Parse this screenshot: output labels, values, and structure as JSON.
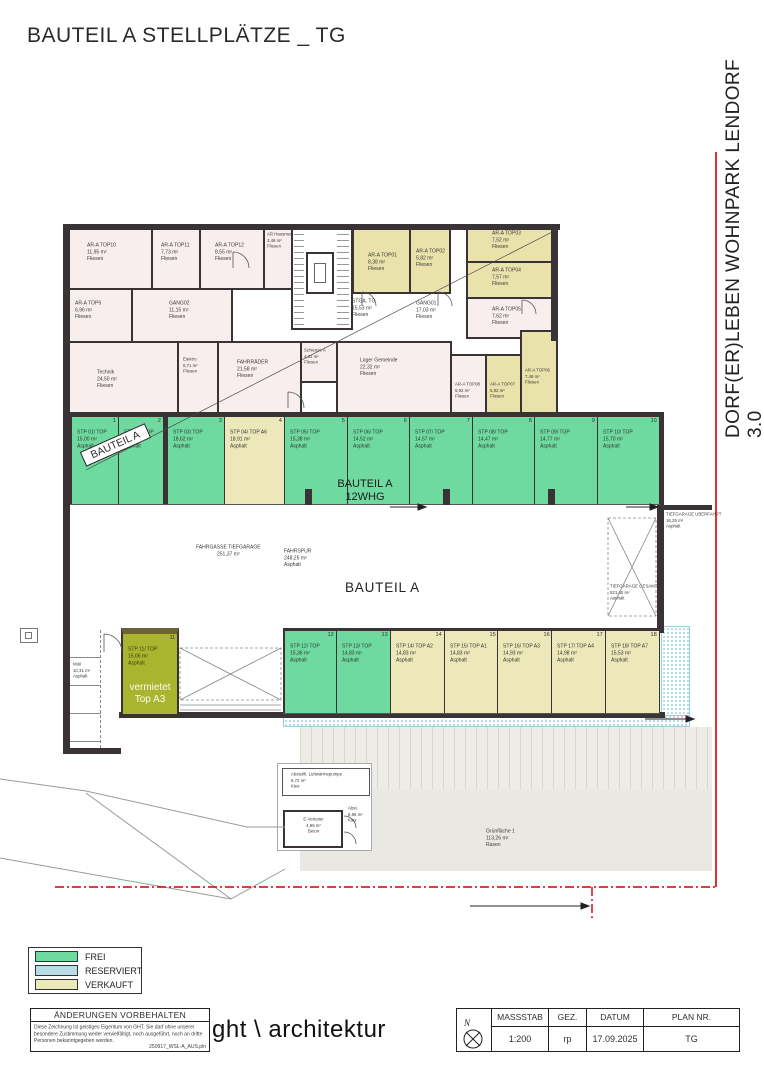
{
  "header": {
    "title": "BAUTEIL A STELLPLÄTZE _ TG"
  },
  "side": {
    "project_title": "DORF(ER)LEBEN WOHNPARK LENDORF 3.0"
  },
  "colors": {
    "frei": "#6fdaa0",
    "reserviert": "#b9dde8",
    "verkauft": "#ece8ba",
    "vermietet": "#a9b52f",
    "wall": "#3a3336",
    "boundary_red": "#cf0000",
    "room_pink": "#f9eeee",
    "room_yellow": "#eae2ab"
  },
  "rooms": [
    {
      "name": "AR-A TOP10",
      "area": "11,95 m²",
      "finish": "Fliesen"
    },
    {
      "name": "AR-A TOP11",
      "area": "7,73 m²",
      "finish": "Fliesen"
    },
    {
      "name": "AR-A TOP12",
      "area": "8,55 m²",
      "finish": "Fliesen"
    },
    {
      "name": "AR Hausmeister",
      "area": "3,46 m²",
      "finish": "Fliesen"
    },
    {
      "name": "AR-A TOP9",
      "area": "6,96 m²",
      "finish": "Fliesen"
    },
    {
      "name": "GANG02",
      "area": "11,15 m²",
      "finish": "Fliesen"
    },
    {
      "name": "AR-A TOP01",
      "area": "8,38 m²",
      "finish": "Fliesen"
    },
    {
      "name": "AR-A TOP02",
      "area": "5,82 m²",
      "finish": "Fliesen"
    },
    {
      "name": "AR-A TOP03",
      "area": "7,52 m²",
      "finish": "Fliesen"
    },
    {
      "name": "AR-A TOP04",
      "area": "7,57 m²",
      "finish": "Fliesen"
    },
    {
      "name": "AR-A TOP05",
      "area": "7,62 m²",
      "finish": "Fliesen"
    },
    {
      "name": "STGA. TG",
      "area": "15,53 m²",
      "finish": "Fliesen"
    },
    {
      "name": "GANG01",
      "area": "17,03 m²",
      "finish": "Fliesen"
    },
    {
      "name": "Technik",
      "area": "24,50 m²",
      "finish": "Fliesen"
    },
    {
      "name": "Elektro",
      "area": "6,71 m²",
      "finish": "Fliesen"
    },
    {
      "name": "FAHRRÄDER",
      "area": "21,58 m²",
      "finish": "Fliesen"
    },
    {
      "name": "Schleuse A",
      "area": "4,32 m²",
      "finish": "Fliesen"
    },
    {
      "name": "Lager Gemeinde",
      "area": "22,32 m²",
      "finish": "Fliesen"
    },
    {
      "name": "AR-A TOP08",
      "area": "5,92 m²",
      "finish": "Fliesen"
    },
    {
      "name": "AR-A TOP07",
      "area": "5,82 m²",
      "finish": "Fliesen"
    },
    {
      "name": "AR-A TOP06",
      "area": "7,48 m²",
      "finish": "Fliesen"
    }
  ],
  "parking": {
    "row1": [
      {
        "num": "1",
        "name": "STP 01/ TOP",
        "area": "15,00 m²",
        "finish": "Asphalt",
        "status": "frei"
      },
      {
        "num": "2",
        "name": "STP 02/ TOP",
        "area": "14,84 m²",
        "finish": "Asphalt",
        "status": "frei"
      },
      {
        "num": "3",
        "name": "STP 03/ TOP",
        "area": "18,62 m²",
        "finish": "Asphalt",
        "status": "frei"
      },
      {
        "num": "4",
        "name": "STP 04/ TOP A6",
        "area": "18,91 m²",
        "finish": "Asphalt",
        "status": "verkauft"
      },
      {
        "num": "5",
        "name": "STP 05/ TOP",
        "area": "15,38 m²",
        "finish": "Asphalt",
        "status": "frei"
      },
      {
        "num": "6",
        "name": "STP 06/ TOP",
        "area": "14,52 m²",
        "finish": "Asphalt",
        "status": "frei"
      },
      {
        "num": "7",
        "name": "STP 07/ TOP",
        "area": "14,57 m²",
        "finish": "Asphalt",
        "status": "frei"
      },
      {
        "num": "8",
        "name": "STP 08/ TOP",
        "area": "14,47 m²",
        "finish": "Asphalt",
        "status": "frei"
      },
      {
        "num": "9",
        "name": "STP 09/ TOP",
        "area": "14,77 m²",
        "finish": "Asphalt",
        "status": "frei"
      },
      {
        "num": "10",
        "name": "STP 10/ TOP",
        "area": "15,70 m²",
        "finish": "Asphalt",
        "status": "frei"
      }
    ],
    "row2": [
      {
        "num": "12",
        "name": "STP 12/ TOP",
        "area": "15,36 m²",
        "finish": "Asphalt",
        "status": "frei"
      },
      {
        "num": "13",
        "name": "STP 13/ TOP",
        "area": "14,83 m²",
        "finish": "Asphalt",
        "status": "frei"
      },
      {
        "num": "14",
        "name": "STP 14/ TOP A2",
        "area": "14,83 m²",
        "finish": "Asphalt",
        "status": "verkauft"
      },
      {
        "num": "15",
        "name": "STP 15/ TOP A1",
        "area": "14,83 m²",
        "finish": "Asphalt",
        "status": "verkauft"
      },
      {
        "num": "16",
        "name": "STP 16/ TOP A3",
        "area": "14,93 m²",
        "finish": "Asphalt",
        "status": "verkauft"
      },
      {
        "num": "17",
        "name": "STP 17/ TOP A4",
        "area": "14,98 m²",
        "finish": "Asphalt",
        "status": "verkauft"
      },
      {
        "num": "18",
        "name": "STP 18/ TOP A7",
        "area": "15,53 m²",
        "finish": "Asphalt",
        "status": "verkauft"
      }
    ],
    "spot11": {
      "num": "11",
      "name": "STP 11/ TOP",
      "area": "15,06 m²",
      "finish": "Asphalt",
      "note_line1": "vermietet",
      "note_line2": "Top A3"
    }
  },
  "areas": {
    "fahrgasse": {
      "name": "FAHRGASSE TIEFGARAGE",
      "area": "251,37 m²"
    },
    "fahrspur": {
      "name": "FAHRSPUR",
      "area": "248,25 m²",
      "finish": "Asphalt"
    },
    "bauteil_big": "BAUTEIL A",
    "bauteil_banner": "BAUTEIL A",
    "bauteil_whg1": "BAUTEIL A",
    "bauteil_whg2": "12WHG",
    "ueberfahrt": {
      "name": "TIEFGARAGE ÜBERFAHRT",
      "area": "16,25 m²",
      "finish": "Asphalt"
    },
    "gesamt": {
      "name": "TIEFGARAGE GESAMT",
      "area": "521,60 m²",
      "finish": "Asphalt"
    },
    "muell": {
      "name": "Müll",
      "area": "10,31 m²",
      "finish": "Asphalt"
    },
    "abstellflaeche": {
      "name": "Abstellfl. Luftwärmepumpe",
      "area": "6,72 m²",
      "finish": "Kies"
    },
    "e_verteiler": {
      "name": "E-Verteiler",
      "area": "4,96 m²",
      "finish": "Beton"
    },
    "abst": {
      "name": "Abst.",
      "area": "6,86 m²",
      "finish": "Kies"
    },
    "gruenflaeche": {
      "name": "Grünfläche 1",
      "area": "113,26 m²",
      "finish": "Rasen"
    }
  },
  "legend": {
    "items": [
      {
        "label": "FREI",
        "color": "#6fdaa0"
      },
      {
        "label": "RESERVIERT",
        "color": "#b9dde8"
      },
      {
        "label": "VERKAUFT",
        "color": "#ece8ba"
      }
    ]
  },
  "titleblock": {
    "changes_header": "ÄNDERUNGEN VORBEHALTEN",
    "disclaimer": "Diese Zeichnung ist geistiges Eigentum von GHT. Sie darf ohne unserer besondere Zustimmung weder vervielfältigt, noch ausgeführt, noch an dritte Personen bekanntgegeben werden.",
    "file": "250917_WSL-A_AUS.pln",
    "firm": "ght \\ architektur",
    "north": "N",
    "fields": [
      {
        "label": "MASSSTAB",
        "value": "1:200"
      },
      {
        "label": "GEZ.",
        "value": "rp"
      },
      {
        "label": "DATUM",
        "value": "17.09.2025"
      },
      {
        "label": "PLAN NR.",
        "value": "TG"
      }
    ]
  }
}
